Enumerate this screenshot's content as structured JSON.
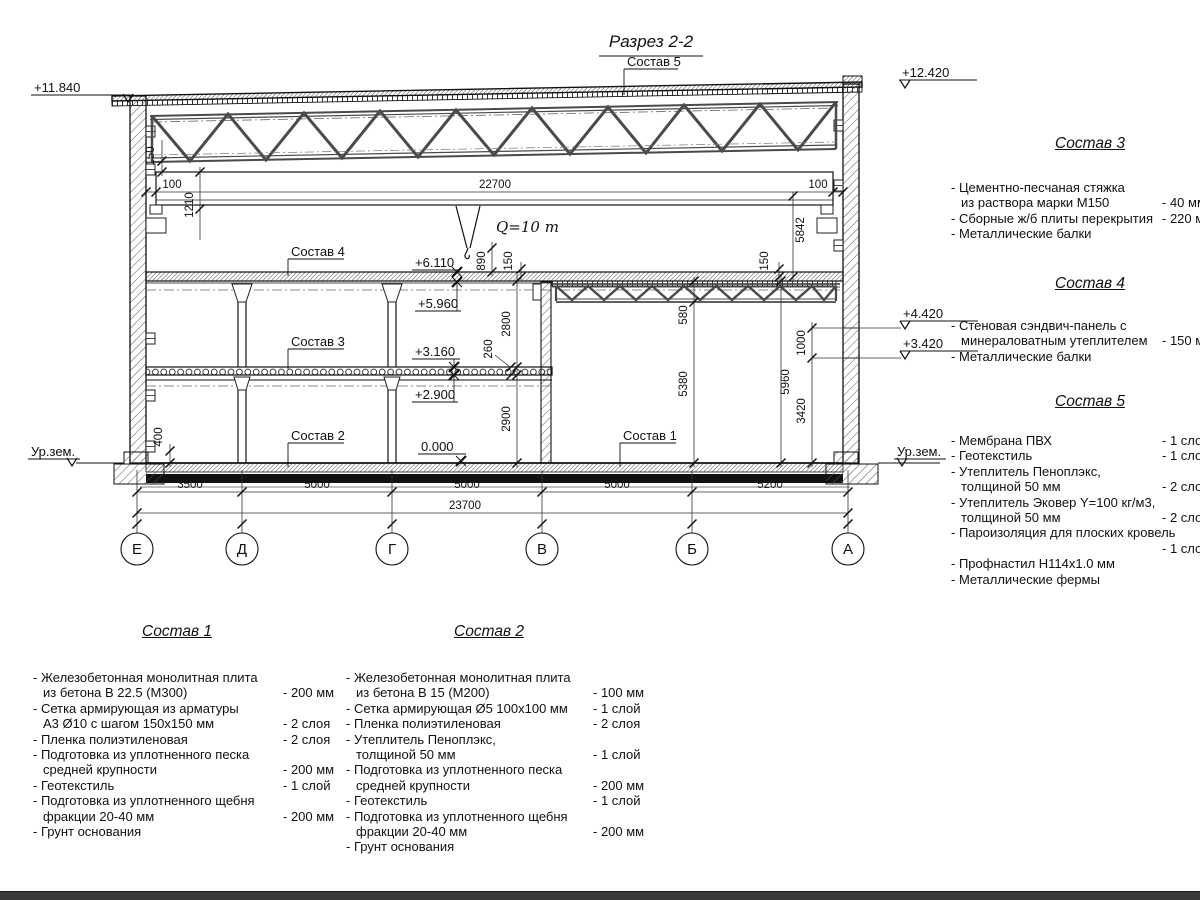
{
  "drawing": {
    "title": "Разрез 2-2",
    "crane_label": "Q=10 т",
    "ground_label": "Ур.зем.",
    "leaders": {
      "s1": "Состав 1",
      "s2": "Состав 2",
      "s3": "Состав 3",
      "s4": "Состав 4",
      "s5": "Состав 5"
    },
    "elevations": {
      "e11840": "+11.840",
      "e12420": "+12.420",
      "e6110": "+6.110",
      "e5960": "+5.960",
      "e3160": "+3.160",
      "e2900": "+2.900",
      "e0": "0.000",
      "e4420": "+4.420",
      "e3420": "+3.420"
    },
    "dims": {
      "d100": "100",
      "d150": "150",
      "d1210": "1210",
      "d22700": "22700",
      "d890": "890",
      "d5842": "5842",
      "d2800": "2800",
      "d260": "260",
      "d2900": "2900",
      "d580": "580",
      "d5380": "5380",
      "d5960": "5960",
      "d1000": "1000",
      "d3420": "3420",
      "d400": "400",
      "d3500": "3500",
      "d5000": "5000",
      "d5200": "5200",
      "d23700": "23700"
    },
    "axes": [
      "Е",
      "Д",
      "Г",
      "В",
      "Б",
      "А"
    ]
  },
  "specs": [
    {
      "heading": "Состав 1",
      "rows": [
        {
          "t": "- Железобетонная  монолитная плита"
        },
        {
          "t": "из бетона В 22.5 (М300)",
          "v": "- 200 мм",
          "i": 1
        },
        {
          "t": "- Сетка армирующая из арматуры"
        },
        {
          "t": "А3 Ø10 с шагом 150х150 мм",
          "v": "- 2 слоя",
          "i": 1
        },
        {
          "t": "- Пленка полиэтиленовая",
          "v": "-  2 слоя"
        },
        {
          "t": "- Подготовка из уплотненного песка"
        },
        {
          "t": "средней крупности",
          "v": "- 200 мм",
          "i": 1
        },
        {
          "t": "- Геотекстиль",
          "v": "- 1 слой"
        },
        {
          "t": "- Подготовка из уплотненного щебня"
        },
        {
          "t": "фракции 20-40 мм",
          "v": "- 200 мм",
          "i": 1
        },
        {
          "t": "- Грунт основания"
        }
      ]
    },
    {
      "heading": "Состав 2",
      "rows": [
        {
          "t": "- Железобетонная  монолитная плита"
        },
        {
          "t": "из бетона В 15 (М200)",
          "v": "- 100 мм",
          "i": 1
        },
        {
          "t": "- Сетка армирующая Ø5 100х100 мм",
          "v": "- 1 слой"
        },
        {
          "t": "- Пленка полиэтиленовая",
          "v": "-  2 слоя"
        },
        {
          "t": "- Утеплитель Пеноплэкс,"
        },
        {
          "t": "толщиной 50 мм",
          "v": "- 1 слой",
          "i": 1
        },
        {
          "t": "- Подготовка из уплотненного песка"
        },
        {
          "t": "средней крупности",
          "v": "- 200 мм",
          "i": 1
        },
        {
          "t": "- Геотекстиль",
          "v": "- 1 слой"
        },
        {
          "t": "- Подготовка из уплотненного щебня"
        },
        {
          "t": "фракции 20-40 мм",
          "v": "- 200 мм",
          "i": 1
        },
        {
          "t": "- Грунт основания"
        }
      ]
    },
    {
      "heading": "Состав 3",
      "rows": [
        {
          "t": "- Цементно-песчаная стяжка"
        },
        {
          "t": "из раствора марки М150",
          "v": "- 40 мм",
          "i": 1
        },
        {
          "t": "- Сборные ж/б плиты перекрытия",
          "v": "- 220 мм"
        },
        {
          "t": "- Металлические балки"
        }
      ]
    },
    {
      "heading": "Состав 4",
      "rows": [
        {
          "t": "- Стеновая сэндвич-панель с"
        },
        {
          "t": "минераловатным утеплителем",
          "v": "- 150 мм",
          "i": 1
        },
        {
          "t": "- Металлические балки"
        }
      ]
    },
    {
      "heading": "Состав 5",
      "rows": [
        {
          "t": "- Мембрана ПВХ",
          "v": "- 1 слой"
        },
        {
          "t": "- Геотекстиль",
          "v": "- 1 слой"
        },
        {
          "t": "- Утеплитель Пеноплэкс,"
        },
        {
          "t": "толщиной 50 мм",
          "v": "- 2 слоя",
          "i": 1
        },
        {
          "t": "- Утеплитель Эковер Y=100 кг/м3,"
        },
        {
          "t": "толщиной 50 мм",
          "v": "- 2 слоя",
          "i": 1
        },
        {
          "t": "- Пароизоляция для плоских кровель"
        },
        {
          "t": "",
          "v": "- 1 слой"
        },
        {
          "t": "- Профнастил Н114х1.0 мм"
        },
        {
          "t": "- Металлические фермы"
        }
      ]
    }
  ]
}
